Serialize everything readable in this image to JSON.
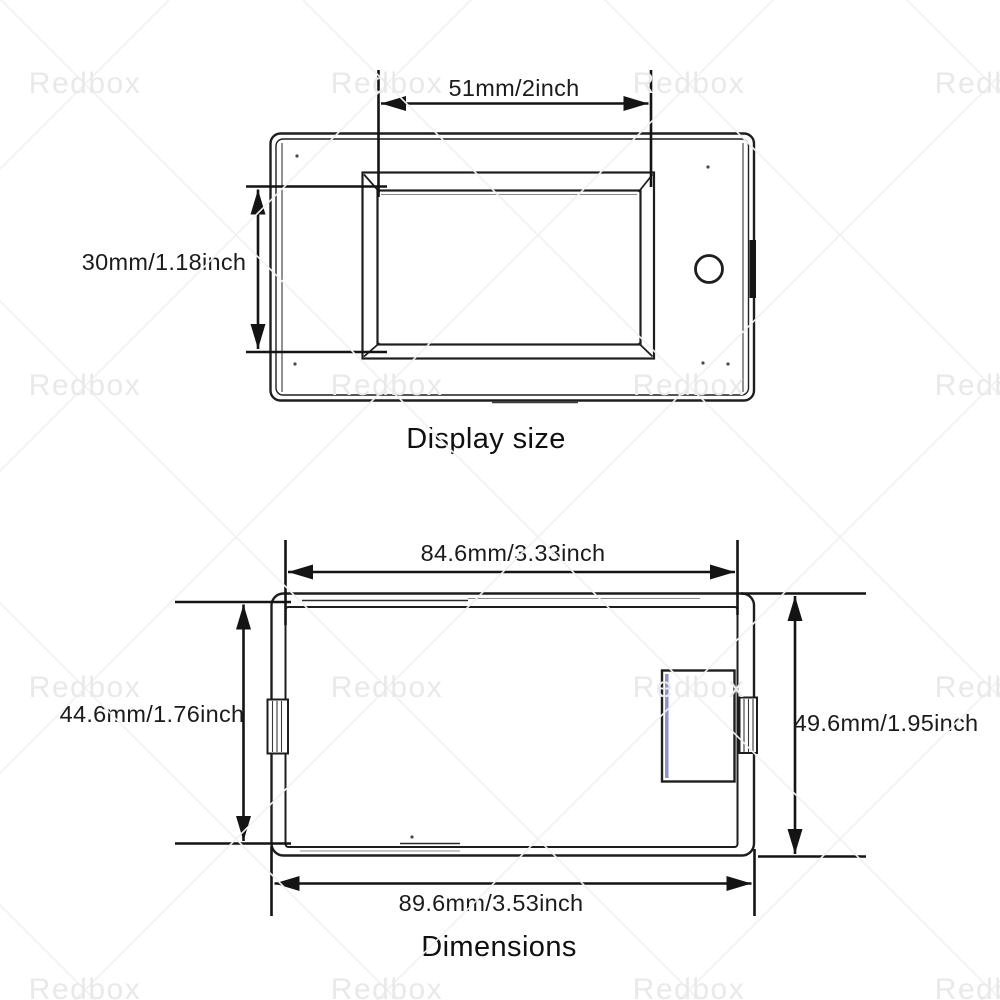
{
  "watermark": {
    "text": "Redbox"
  },
  "display_view": {
    "title": "Display size",
    "width_label": "51mm/2inch",
    "height_label": "30mm/1.18inch"
  },
  "dimensions_view": {
    "title": "Dimensions",
    "top_width_label": "84.6mm/3.33inch",
    "left_height_label": "44.6mm/1.76inch",
    "right_height_label": "49.6mm/1.95inch",
    "bottom_width_label": "89.6mm/3.53inch"
  },
  "colors": {
    "line": "#1e1e1e",
    "connector_stripe_blue": "#8f94c6",
    "watermark_gray": "#e9e9eb",
    "background": "#ffffff"
  }
}
